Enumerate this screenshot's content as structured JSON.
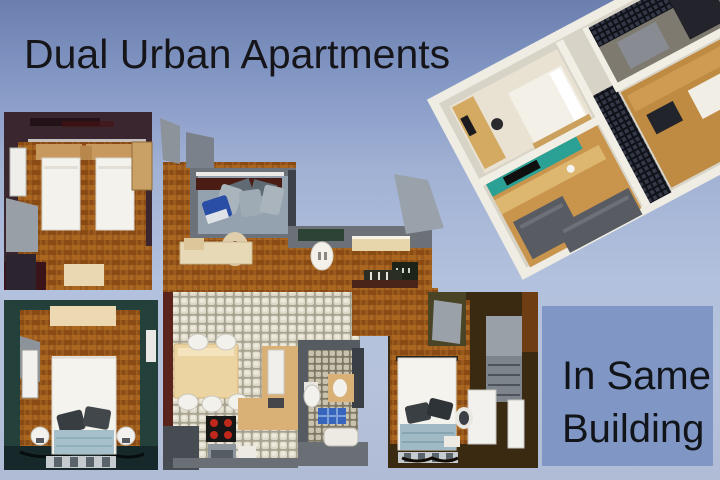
{
  "texts": {
    "title": "Dual Urban Apartments",
    "caption_line1": "In Same",
    "caption_line2": "Building"
  },
  "palette": {
    "background_top": "#6b7fae",
    "background_mid": "#b2c1dd",
    "background_bottom": "#b0bcd5",
    "caption_panel_blue": "#8096c5",
    "text_black": "#16161a",
    "parquet_brown": "#9a5a1d",
    "mosaic_tile": "#ddd8c8",
    "bathroom_tile": "#c9c3ae",
    "plum_wall": "#39262e",
    "teal_wall": "#24403a",
    "dark_brown_wall": "#3a2a12",
    "grey_wall": "#6d727a",
    "maroon_accent": "#4a1c14",
    "teal_accent_3d": "#2ba094",
    "wood_3d": "#c9944c",
    "dark_tile_3d": "#101219",
    "bed_white": "#f4f2ec",
    "pillow_grey": "#3c4046",
    "blanket_blue": "#a6c0cb",
    "shower_blue": "#3765bd",
    "stove_burner_red": "#c0281c"
  },
  "scene": {
    "type": "real-estate-listing-cover",
    "elements": [
      {
        "name": "floor-plan-2d",
        "description": "top-down floor plan collage of two apartments"
      },
      {
        "name": "render-3d",
        "description": "isometric 3D apartment render, tilted"
      },
      {
        "name": "twin-bedroom",
        "description": "two single beds, plum walls"
      },
      {
        "name": "living-nook",
        "description": "grey cushions, blue chair, red media strip"
      },
      {
        "name": "hallway",
        "description": "parquet corridor with benches and tables"
      },
      {
        "name": "kitchen-dining",
        "description": "mosaic floor, wood table, stove with red burners"
      },
      {
        "name": "bathroom",
        "description": "toilet, sink, blue shower mat, tub"
      },
      {
        "name": "double-bedroom-left",
        "description": "teal walls, white double bed"
      },
      {
        "name": "double-bedroom-right",
        "description": "brown walls, white double bed, desk, wardrobe"
      }
    ]
  }
}
